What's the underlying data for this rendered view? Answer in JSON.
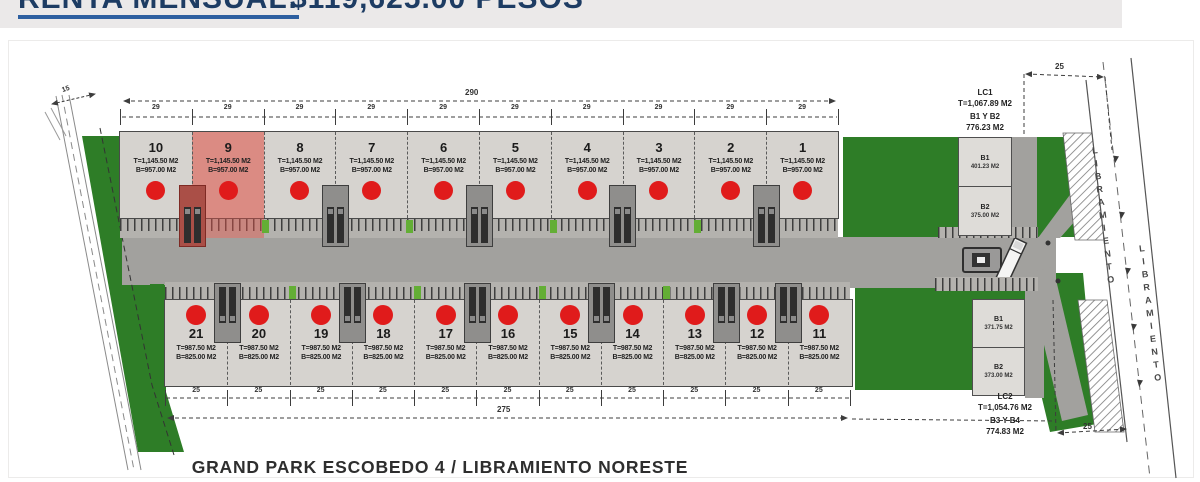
{
  "renta_bar": {
    "label": "RENTA MENSUAL:",
    "value": "$119,625.00 PESOS"
  },
  "plan": {
    "title": "GRAND PARK ESCOBEDO 4 / LIBRAMIENTO NORESTE",
    "road_label": "LIBRAMIENTO"
  },
  "dimensions": {
    "left_width": "15",
    "top_overall": "290",
    "top_segment": "29",
    "bottom_overall": "275",
    "bottom_segment": "25",
    "right_top": "25",
    "right_bottom": "25"
  },
  "top_row": {
    "area_t": "T=1,145.50 M2",
    "area_b": "B=957.00 M2",
    "highlighted_unit": "9",
    "units": [
      "10",
      "9",
      "8",
      "7",
      "6",
      "5",
      "4",
      "3",
      "2",
      "1"
    ]
  },
  "bottom_row": {
    "area_t": "T=987.50 M2",
    "area_b": "B=825.00 M2",
    "highlighted_unit": "",
    "units": [
      "21",
      "20",
      "19",
      "18",
      "17",
      "16",
      "15",
      "14",
      "13",
      "12",
      "11"
    ]
  },
  "lc1": {
    "name": "LC1",
    "total": "T=1,067.89 M2",
    "pair": "B1 Y B2",
    "pair_area": "776.23 M2"
  },
  "lc2": {
    "name": "LC2",
    "total": "T=1,054.76 M2",
    "pair": "B3 Y B4",
    "pair_area": "774.83 M2"
  },
  "blocks_top": [
    {
      "name": "B1",
      "area": "401.23 M2"
    },
    {
      "name": "B2",
      "area": "375.00 M2"
    }
  ],
  "blocks_bottom": [
    {
      "name": "B1",
      "area": "371.75 M2"
    },
    {
      "name": "B2",
      "area": "373.00 M2"
    }
  ],
  "colors": {
    "marker_red": "#e01b1b",
    "highlight_red": "#e2564c",
    "green": "#2e7d27",
    "navy": "#1d3c63"
  }
}
